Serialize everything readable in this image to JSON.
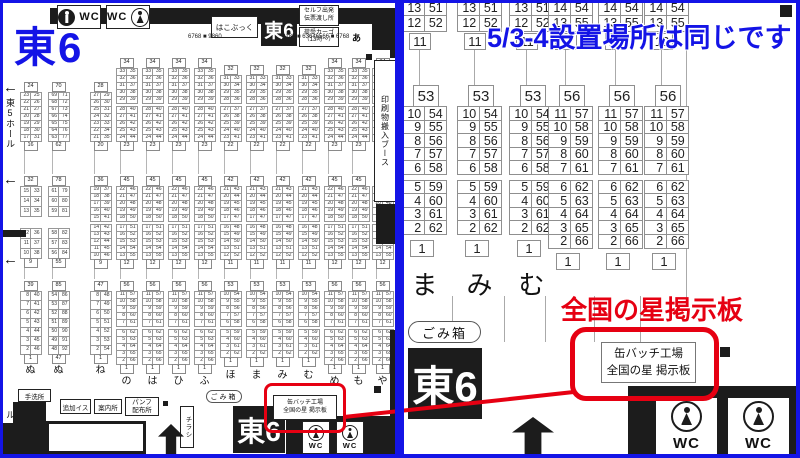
{
  "colors": {
    "accent_blue": "#1414e6",
    "accent_red": "#e60012",
    "wall_black": "#1c1c1c",
    "cell_border": "#8f8f8f"
  },
  "left_panel": {
    "hall_title": "東6",
    "top": {
      "wc": "WC",
      "hakobukku": "はこぶっく",
      "hall_box": "東6",
      "self_box_line1": "セルフ出発",
      "self_box_line2": "伝票渡し所",
      "cargo_line1": "荷受カーゴ",
      "cargo_line2": "（13時〜）",
      "strip_left": "6768 ■ 9860",
      "strip_right": "8182 ■ 63646566 ■ 6768",
      "row_a_label": "あ"
    },
    "west_edge": {
      "hall5": "東5ホール",
      "hall5_lower": "東5ホール",
      "arrow": "←"
    },
    "east_edge": {
      "insatsu": "印刷物搬入ブース"
    },
    "bottom": {
      "tearaijo": "手洗所",
      "tsuika_isu": "追加イス",
      "annaijo": "案内所",
      "panfu_line1": "パンフ",
      "panfu_line2": "配布所",
      "chirashi": "チラシ",
      "gomibako": "ごみ箱",
      "hall_box": "東6",
      "booth_line1": "缶バッチ工場",
      "booth_line2": "全国の星 掲示板",
      "wc": "WC"
    },
    "patterns": {
      "A": {
        "s1": {
          "off": 24,
          "h": 7,
          "gap": 0,
          "hdr": "24",
          "r1": [
            "23|25",
            "22|26",
            "21|27",
            "20|28"
          ],
          "r2": [
            "19|29",
            "18|30",
            "17|31"
          ],
          "ftr": "16"
        },
        "s2": {
          "h": 10,
          "gap": 12,
          "hdr": "32",
          "r1": [
            "15|33",
            "14|34",
            "13|35"
          ],
          "r2": [
            "12|36",
            "11|37",
            "10|38"
          ],
          "ftr": "9"
        },
        "s3": {
          "h": 9,
          "gap": 0,
          "hdr": "39",
          "r1": [
            "8|40",
            "7|41",
            "6|42",
            "5|43",
            "4|44"
          ],
          "r2": [
            "3|45",
            "2|46"
          ],
          "ftr": "1"
        },
        "labelY": 361
      },
      "B": {
        "s1": {
          "off": 24,
          "h": 7,
          "gap": 0,
          "hdr": "70",
          "r1": [
            "69|71",
            "68|72",
            "67|73",
            "66|74"
          ],
          "r2": [
            "65|75",
            "64|76",
            "63|77"
          ],
          "ftr": "62"
        },
        "s2": {
          "h": 10,
          "gap": 12,
          "hdr": "78",
          "r1": [
            "61|79",
            "60|80",
            "59|81"
          ],
          "r2": [
            "58|82",
            "57|83",
            "56|84"
          ],
          "ftr": "55"
        },
        "s3": {
          "h": 9,
          "gap": 0,
          "hdr": "85",
          "r1": [
            "54|86",
            "53|87",
            "52|88",
            "51|89",
            "50|90"
          ],
          "r2": [
            "49|91",
            "48|92"
          ],
          "ftr": "47"
        },
        "labelY": 361
      },
      "C": {
        "s1": {
          "off": 24,
          "h": 7,
          "gap": 0,
          "hdr": "28",
          "r1": [
            "27|29",
            "26|30",
            "25|31",
            "24|32"
          ],
          "r2": [
            "23|33",
            "22|34",
            "21|35"
          ],
          "ftr": "20"
        },
        "s2": {
          "h": 7,
          "gap": 3,
          "hdr": "36",
          "r1": [
            "19|37",
            "18|38",
            "17|39",
            "16|40",
            "15|41"
          ],
          "r2": [
            "14|42",
            "13|43",
            "12|44",
            "11|45",
            "10|46"
          ],
          "ftr": "9"
        },
        "s3": {
          "h": 9,
          "gap": 0,
          "hdr": "47",
          "r1": [
            "8|48",
            "7|49",
            "6|50",
            "5|51",
            "4|52"
          ],
          "r2": [
            "3|53",
            "2|54"
          ],
          "ftr": "1"
        },
        "labelY": 361
      },
      "D": {
        "s1": {
          "off": 0,
          "h": 7,
          "gap": 3,
          "hdr": "34",
          "r1": [
            "33|35",
            "32|36",
            "31|37",
            "30|38",
            "29|39"
          ],
          "r2": [
            "28|40",
            "27|41",
            "26|42",
            "25|43",
            "24|44"
          ],
          "ftr": "23"
        },
        "s2": {
          "h": 7,
          "gap": 3,
          "hdr": "45",
          "r1": [
            "22|46",
            "21|47",
            "20|48",
            "19|49",
            "18|50"
          ],
          "r2": [
            "17|51",
            "16|52",
            "15|53",
            "14|54",
            "13|55"
          ],
          "ftr": "12"
        },
        "s3": {
          "h": 7,
          "gap": 3,
          "hdr": "56",
          "r1": [
            "11|57",
            "10|58",
            "9|59",
            "8|60",
            "7|61"
          ],
          "r2": [
            "6|62",
            "5|63",
            "4|64",
            "3|65",
            "2|66"
          ],
          "ftr": "1"
        },
        "labelY": 372
      },
      "E": {
        "s1": {
          "off": 7,
          "h": 7,
          "gap": 3,
          "hdr": "32",
          "r1": [
            "31|33",
            "30|34",
            "29|35",
            "28|36"
          ],
          "r2": [
            "27|37",
            "26|38",
            "25|39",
            "24|40",
            "23|41"
          ],
          "ftr": "22"
        },
        "s2": {
          "h": 7,
          "gap": 3,
          "hdr": "42",
          "r1": [
            "21|43",
            "20|44",
            "19|45",
            "18|46",
            "17|47"
          ],
          "r2": [
            "16|48",
            "15|49",
            "14|50",
            "13|51",
            "12|52"
          ],
          "ftr": "11"
        },
        "s3": {
          "h": 7,
          "gap": 3,
          "hdr": "53",
          "r1": [
            "10|54",
            "9|55",
            "8|56",
            "7|57",
            "6|58"
          ],
          "r2": [
            "5|59",
            "4|60",
            "3|61",
            "2|62"
          ],
          "ftr": "1"
        },
        "labelY": 366
      }
    },
    "columns": [
      {
        "x": 20,
        "p": "A",
        "label": "ぬ"
      },
      {
        "x": 48,
        "p": "B",
        "label": "ぬ"
      },
      {
        "x": 90,
        "p": "C",
        "label": "ね"
      },
      {
        "x": 116,
        "p": "D",
        "label": "の"
      },
      {
        "x": 142,
        "p": "D",
        "label": "は"
      },
      {
        "x": 168,
        "p": "D",
        "label": "ひ"
      },
      {
        "x": 194,
        "p": "D",
        "label": "ふ"
      },
      {
        "x": 220,
        "p": "E",
        "label": "ほ"
      },
      {
        "x": 246,
        "p": "E",
        "label": "ま"
      },
      {
        "x": 272,
        "p": "E",
        "label": "み"
      },
      {
        "x": 298,
        "p": "E",
        "label": "む"
      },
      {
        "x": 324,
        "p": "D",
        "label": "め"
      },
      {
        "x": 348,
        "p": "D",
        "label": "も"
      },
      {
        "x": 372,
        "p": "D",
        "label": "や"
      }
    ]
  },
  "right_panel": {
    "note": "5/3-4設置場所は同じです",
    "red_label": "全国の星掲示板",
    "booth_line1": "缶バッチ工場",
    "booth_line2": "全国の星 掲示板",
    "gomibako": "ごみ箱",
    "hall_box": "東6",
    "wc": "WC",
    "patterns": {
      "P1": {
        "top": [
          "13|51",
          "12|52"
        ],
        "ts": "11",
        "hdr": "53",
        "r1": [
          "10|54",
          "9|55",
          "8|56",
          "7|57",
          "6|58"
        ],
        "r2": [
          "5|59",
          "4|60",
          "3|61",
          "2|62"
        ],
        "bs": "1"
      },
      "P2": {
        "top": [
          "14|54",
          "13|55"
        ],
        "ts": "12",
        "hdr": "56",
        "r1": [
          "11|57",
          "10|58",
          "9|59",
          "8|60",
          "7|61"
        ],
        "r2": [
          "6|62",
          "5|63",
          "4|64",
          "3|65",
          "2|66"
        ],
        "bs": "1"
      }
    },
    "columns": [
      {
        "x": 403,
        "p": "P1",
        "label": "ま"
      },
      {
        "x": 458,
        "p": "P1",
        "label": "み"
      },
      {
        "x": 510,
        "p": "P1",
        "label": "む"
      },
      {
        "x": 549,
        "p": "P2",
        "label": ""
      },
      {
        "x": 599,
        "p": "P2",
        "label": ""
      },
      {
        "x": 645,
        "p": "P2",
        "label": ""
      }
    ]
  }
}
